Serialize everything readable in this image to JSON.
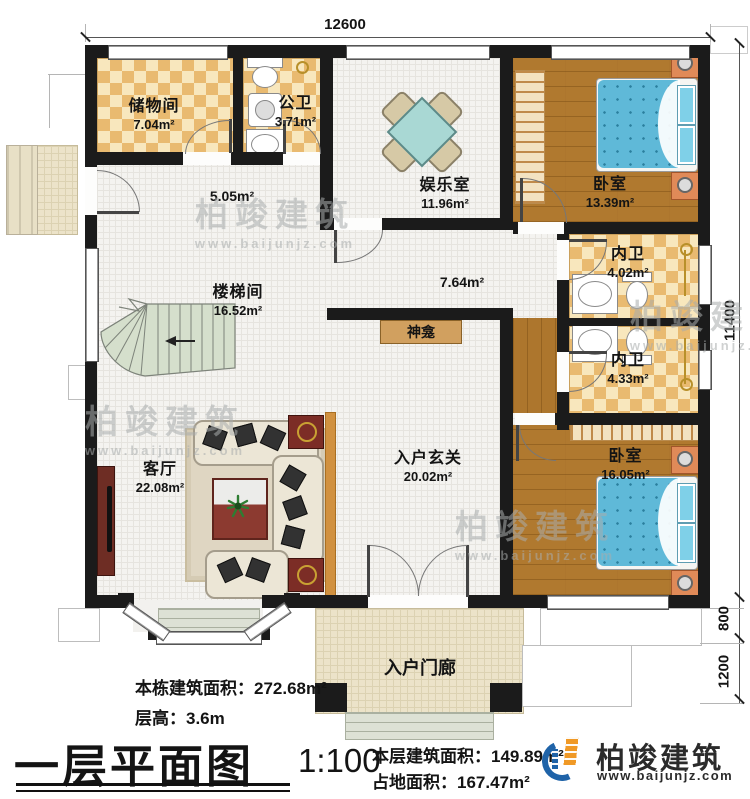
{
  "dimensions": {
    "width_top": "12600",
    "height_right": "11400",
    "ledge_right": "800",
    "porch_right": "1200"
  },
  "rooms": {
    "storage": {
      "name": "储物间",
      "area": "7.04m²"
    },
    "public_bath": {
      "name": "公卫",
      "area": "3.71m²"
    },
    "entertainment": {
      "name": "娱乐室",
      "area": "11.96m²"
    },
    "bedroom_top": {
      "name": "卧室",
      "area": "13.39m²"
    },
    "inner_bath_upper": {
      "name": "内卫",
      "area": "4.02m²"
    },
    "inner_bath_lower": {
      "name": "内卫",
      "area": "4.33m²"
    },
    "bedroom_bottom": {
      "name": "卧室",
      "area": "16.05m²"
    },
    "stair_hall": {
      "name": "楼梯间",
      "area": "16.52m²"
    },
    "living_room": {
      "name": "客厅",
      "area": "22.08m²"
    },
    "foyer": {
      "name": "入户玄关",
      "area": "20.02m²"
    },
    "porch": {
      "name": "入户门廊"
    },
    "shrine": {
      "name": "神龛"
    },
    "hallway": {
      "area": "5.05m²"
    },
    "corridor": {
      "area": "7.64m²"
    }
  },
  "footer": {
    "total_area": "本栋建筑面积：272.68m²",
    "floor_height": "层高：3.6m",
    "title": "一层平面图",
    "scale": "1:100",
    "floor_area": "本层建筑面积：149.89m²",
    "footprint": "占地面积：167.47m²"
  },
  "logo": {
    "name": "柏竣建筑",
    "website": "www.baijunjz.com"
  },
  "watermark": {
    "text": "柏竣建筑",
    "url": "www.baijunjz.com"
  },
  "colors": {
    "wall": "#1b1b1b",
    "checker_floor": "#e9ba70",
    "wood_floor": "#b0792f",
    "bed": "#5fb9d8",
    "logo_blue": "#1f63a8",
    "logo_orange": "#f09926"
  }
}
